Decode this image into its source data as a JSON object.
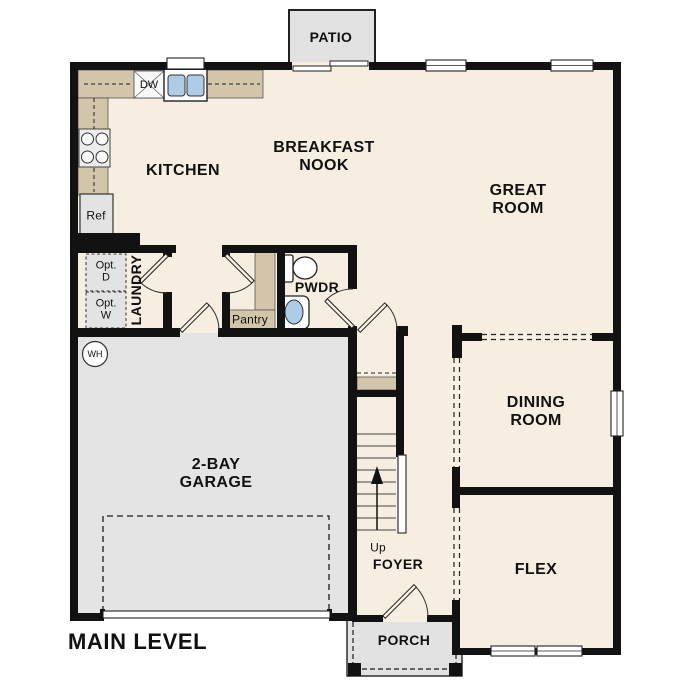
{
  "plan": {
    "title": "MAIN LEVEL",
    "rooms": {
      "patio": "PATIO",
      "kitchen": "KITCHEN",
      "breakfast_nook": "BREAKFAST\nNOOK",
      "great_room": "GREAT\nROOM",
      "laundry": "LAUNDRY",
      "pantry": "Pantry",
      "powder": "PWDR",
      "dining_room": "DINING\nROOM",
      "garage": "2-BAY\nGARAGE",
      "foyer": "FOYER",
      "flex": "FLEX",
      "porch": "PORCH"
    },
    "labels": {
      "dishwasher": "DW",
      "refrigerator": "Ref",
      "opt_dryer": "Opt.\nD",
      "opt_washer": "Opt.\nW",
      "water_heater": "WH",
      "stairs_direction": "Up"
    },
    "colors": {
      "floor": "#f6eee1",
      "garage_floor": "#e4e4e4",
      "outdoor": "#e2e2e2",
      "counter_tan": "#d2c5aa",
      "wall": "#121212",
      "sink_blue": "#aecbe8"
    }
  }
}
